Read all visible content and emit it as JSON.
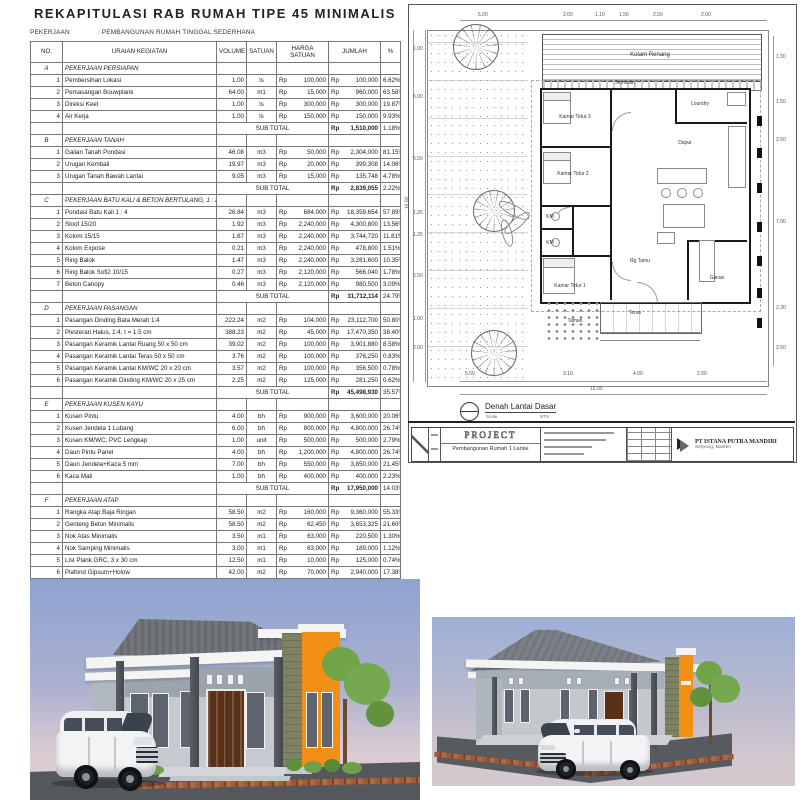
{
  "rab_table": {
    "title": "REKAPITULASI RAB RUMAH TIPE 45 MINIMALIS",
    "pekerjaan_label": "PEKERJAAN",
    "pekerjaan_value": ": PEMBANGUNAN RUMAH TINGGAL SEDERHANA",
    "currency": "Rp",
    "sub_total_label": "SUB TOTAL",
    "columns": [
      "NO.",
      "URAIAN KEGIATAN",
      "VOLUME",
      "SATUAN",
      "HARGA SATUAN",
      "JUMLAH",
      "%"
    ],
    "sections": [
      {
        "code": "A",
        "name": "PEKERJAAN PERSIAPAN",
        "sub_total": "1,510,000",
        "sub_pct": "1.18%",
        "items": [
          {
            "no": "1",
            "uraian": "Pembersihan Lokasi",
            "volume": "1.00",
            "satuan": "ls",
            "harga": "100,000",
            "jumlah": "100,000",
            "pct": "6.62%"
          },
          {
            "no": "2",
            "uraian": "Pemasangan Bouwplank",
            "volume": "64.00",
            "satuan": "m1",
            "harga": "15,000",
            "jumlah": "960,000",
            "pct": "63.58%"
          },
          {
            "no": "3",
            "uraian": "Direksi Keet",
            "volume": "1.00",
            "satuan": "ls",
            "harga": "300,000",
            "jumlah": "300,000",
            "pct": "19.87%"
          },
          {
            "no": "4",
            "uraian": "Air Kerja",
            "volume": "1.00",
            "satuan": "ls",
            "harga": "150,000",
            "jumlah": "150,000",
            "pct": "9.93%"
          }
        ]
      },
      {
        "code": "B",
        "name": "PEKERJAAN TANAH",
        "sub_total": "2,839,055",
        "sub_pct": "2.22%",
        "items": [
          {
            "no": "1",
            "uraian": "Galian Tanah Pondasi",
            "volume": "46.08",
            "satuan": "m3",
            "harga": "50,000",
            "jumlah": "2,304,000",
            "pct": "81.15%"
          },
          {
            "no": "2",
            "uraian": "Urugan Kembali",
            "volume": "19.97",
            "satuan": "m3",
            "harga": "20,000",
            "jumlah": "399,308",
            "pct": "14.06%"
          },
          {
            "no": "3",
            "uraian": "Urugan Tanah Bawah Lantai",
            "volume": "9.05",
            "satuan": "m3",
            "harga": "15,000",
            "jumlah": "135,748",
            "pct": "4.78%"
          }
        ]
      },
      {
        "code": "C",
        "name": "PEKERJAAN BATU KALI & BETON BERTULANG, 1 : 2 : 3",
        "sub_total": "31,712,114",
        "sub_pct": "24.79%",
        "items": [
          {
            "no": "1",
            "uraian": "Pondasi Batu Kali 1 : 4",
            "volume": "26.84",
            "satuan": "m3",
            "harga": "684,000",
            "jumlah": "18,359,654",
            "pct": "57.89%"
          },
          {
            "no": "2",
            "uraian": "Sloof 15/20",
            "volume": "1.92",
            "satuan": "m3",
            "harga": "2,240,000",
            "jumlah": "4,300,800",
            "pct": "13.56%"
          },
          {
            "no": "3",
            "uraian": "Kolom 15/15",
            "volume": "1.67",
            "satuan": "m3",
            "harga": "2,240,000",
            "jumlah": "3,744,720",
            "pct": "11.81%"
          },
          {
            "no": "4",
            "uraian": "Kolom Expose",
            "volume": "0.21",
            "satuan": "m3",
            "harga": "2,240,000",
            "jumlah": "478,800",
            "pct": "1.51%"
          },
          {
            "no": "5",
            "uraian": "Ring Balok",
            "volume": "1.47",
            "satuan": "m3",
            "harga": "2,240,000",
            "jumlah": "3,281,600",
            "pct": "10.35%"
          },
          {
            "no": "6",
            "uraian": "Ring Balok Sofi2 10/15",
            "volume": "0.27",
            "satuan": "m3",
            "harga": "2,120,000",
            "jumlah": "566,040",
            "pct": "1.78%"
          },
          {
            "no": "7",
            "uraian": "Beton Canopy",
            "volume": "0.46",
            "satuan": "m3",
            "harga": "2,120,000",
            "jumlah": "980,500",
            "pct": "3.09%"
          }
        ]
      },
      {
        "code": "D",
        "name": "PEKERJAAN PASANGAN",
        "sub_total": "45,498,930",
        "sub_pct": "35.57%",
        "items": [
          {
            "no": "1",
            "uraian": "Pasangan Dinding Bata Merah 1:4",
            "volume": "222.24",
            "satuan": "m2",
            "harga": "104,000",
            "jumlah": "23,112,700",
            "pct": "50.80%"
          },
          {
            "no": "2",
            "uraian": "Plesteran Halus, 1:4, t = 1.5 cm",
            "volume": "388.23",
            "satuan": "m2",
            "harga": "45,000",
            "jumlah": "17,470,350",
            "pct": "38.40%"
          },
          {
            "no": "3",
            "uraian": "Pasangan Keramik Lantai Ruang 50 x 50 cm",
            "volume": "39.02",
            "satuan": "m2",
            "harga": "100,000",
            "jumlah": "3,901,880",
            "pct": "8.58%"
          },
          {
            "no": "4",
            "uraian": "Pasangan Keramik Lantai Teras 50 x 50 cm",
            "volume": "3.76",
            "satuan": "m2",
            "harga": "100,000",
            "jumlah": "376,250",
            "pct": "0.83%"
          },
          {
            "no": "5",
            "uraian": "Pasangan Keramik Lantai KM/WC 20 x 20 cm",
            "volume": "3.57",
            "satuan": "m2",
            "harga": "100,000",
            "jumlah": "356,500",
            "pct": "0.78%"
          },
          {
            "no": "6",
            "uraian": "Pasangan Keramik Dinding KM/WC 20 x 25 cm",
            "volume": "2.25",
            "satuan": "m2",
            "harga": "125,000",
            "jumlah": "281,250",
            "pct": "0.62%"
          }
        ]
      },
      {
        "code": "E",
        "name": "PEKERJAAN KUSEN KAYU",
        "sub_total": "17,950,000",
        "sub_pct": "14.03%",
        "items": [
          {
            "no": "1",
            "uraian": "Kusen Pintu",
            "volume": "4.00",
            "satuan": "bh",
            "harga": "900,000",
            "jumlah": "3,600,000",
            "pct": "20.06%"
          },
          {
            "no": "2",
            "uraian": "Kusen Jendela 1 Lubang",
            "volume": "6.00",
            "satuan": "bh",
            "harga": "800,000",
            "jumlah": "4,800,000",
            "pct": "26.74%"
          },
          {
            "no": "3",
            "uraian": "Kusen KM/WC, PVC Lengkap",
            "volume": "1.00",
            "satuan": "unit",
            "harga": "500,000",
            "jumlah": "500,000",
            "pct": "2.79%"
          },
          {
            "no": "4",
            "uraian": "Daun Pintu Panel",
            "volume": "4.00",
            "satuan": "bh",
            "harga": "1,200,000",
            "jumlah": "4,800,000",
            "pct": "26.74%"
          },
          {
            "no": "5",
            "uraian": "Daun Jendela+Kaca 5 mm",
            "volume": "7.00",
            "satuan": "bh",
            "harga": "550,000",
            "jumlah": "3,850,000",
            "pct": "21.45%"
          },
          {
            "no": "6",
            "uraian": "Kaca Mati",
            "volume": "1.00",
            "satuan": "bh",
            "harga": "400,000",
            "jumlah": "400,000",
            "pct": "2.23%"
          }
        ]
      },
      {
        "code": "F",
        "name": "PEKERJAAN ATAP",
        "sub_total": "16,915,825",
        "sub_pct": "13.22%",
        "items": [
          {
            "no": "1",
            "uraian": "Rangka Atap Baja Ringan",
            "volume": "58.50",
            "satuan": "m2",
            "harga": "160,000",
            "jumlah": "9,360,000",
            "pct": "55.33%"
          },
          {
            "no": "2",
            "uraian": "Genteng Beton Minimalis",
            "volume": "58.50",
            "satuan": "m2",
            "harga": "62,450",
            "jumlah": "3,653,325",
            "pct": "21.60%"
          },
          {
            "no": "3",
            "uraian": "Nok Atas Minimalis",
            "volume": "3.50",
            "satuan": "m1",
            "harga": "63,000",
            "jumlah": "220,500",
            "pct": "1.30%"
          },
          {
            "no": "4",
            "uraian": "Nok Samping Minimalis",
            "volume": "3.00",
            "satuan": "m1",
            "harga": "63,000",
            "jumlah": "189,000",
            "pct": "1.12%"
          },
          {
            "no": "5",
            "uraian": "List Plank GRC, 3 x 30 cm",
            "volume": "12.50",
            "satuan": "m1",
            "harga": "10,000",
            "jumlah": "125,000",
            "pct": "0.74%"
          },
          {
            "no": "6",
            "uraian": "Plafond Gipsum+Holow",
            "volume": "42.00",
            "satuan": "m2",
            "harga": "70,000",
            "jumlah": "2,940,000",
            "pct": "17.38%"
          },
          {
            "no": "7",
            "uraian": "List Plafond",
            "volume": "53.50",
            "satuan": "m1",
            "harga": "8,000",
            "jumlah": "428,000",
            "pct": "2.53%"
          }
        ]
      }
    ]
  },
  "floor_plan": {
    "rooms": {
      "kolam_renang": "Kolam Renang",
      "jemuran": "Jemuran",
      "kamar_tidur_3": "Kamar Tidur 3",
      "loundry": "Loundry",
      "dapur": "Dapur",
      "kamar_tidur_2": "Kamar Tidur 2",
      "km_atas": "KM",
      "km_bawah": "KM",
      "kamar_tidur_1": "Kamar Tidur 1",
      "rg_tamu": "Rg Tamu",
      "teras": "Teras",
      "garasi": "Garasi",
      "taman": "Taman"
    },
    "top_dims": [
      "5.00",
      "2.00",
      "1.10",
      "1.50",
      "2.50",
      "2.00"
    ],
    "bottom_dims": [
      "5.00",
      "3.10",
      "4.00",
      "2.00"
    ],
    "left_dims": [
      "1.00",
      "5.00",
      "5.50",
      "1.25",
      "1.25",
      "5.50",
      "1.00",
      "2.00"
    ],
    "right_dims": [
      "1.30",
      "1.50",
      "2.50",
      "7.00",
      "2.30",
      "2.50"
    ],
    "width_total": "15.00",
    "height_total": "16.00",
    "tag": {
      "title": "Denah Lantai Dasar",
      "scale_label": "Scale",
      "scale_value": "NTS"
    },
    "title_block": {
      "project_title": "PROJECT",
      "project_subtitle": "Pembangunan Rumah 1 Lantai",
      "company_name": "PT ISTANA PUTRA MANDIRI",
      "company_location": "Serpong, Banten"
    }
  },
  "renders": {
    "colors": {
      "sky_blue": "#8fa3d0",
      "sky_haze": "#d9cbd1",
      "roof_gray": "#72767b",
      "wall_gray_light": "#c6cad0",
      "wall_gray_dark": "#9ba3ad",
      "fascia_white": "#f4f4f2",
      "accent_orange": "#f28f15",
      "stone_green": "#7e8262",
      "door_brown": "#5a3017",
      "ground_gray": "#54585c",
      "brick_red": "#96542f",
      "van_white": "#f2f3f4",
      "foliage_green": "#76a84f"
    }
  }
}
